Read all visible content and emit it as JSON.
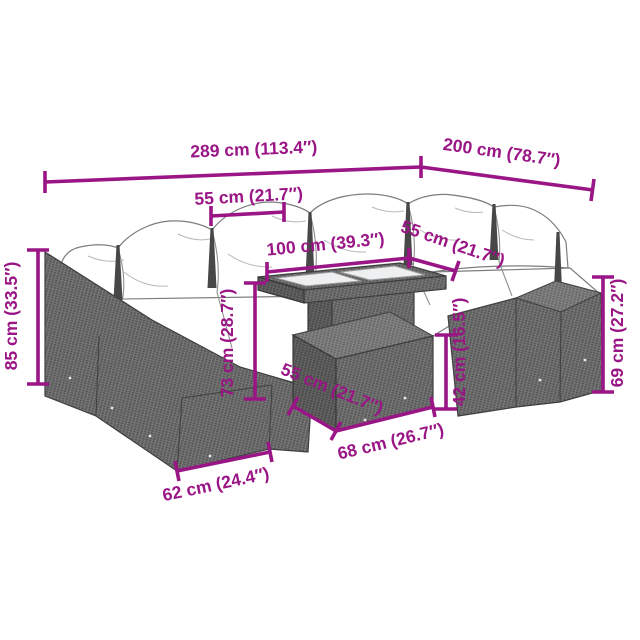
{
  "colors": {
    "dimension_magenta": "#9a1585",
    "rattan_gray": "#6f6f6f",
    "outline_gray": "#3e3e3e",
    "cushion_white": "#ffffff",
    "glass_gray": "#edeff0",
    "background": "#ffffff"
  },
  "diagram": {
    "type": "product-dimension-diagram",
    "subject": "rattan garden lounge set with cushions, glass-top table and footstool"
  },
  "dimensions": [
    {
      "name": "set-total-width",
      "label": "289 cm (113.4″)"
    },
    {
      "name": "set-side-depth",
      "label": "200 cm (78.7″)"
    },
    {
      "name": "seat-section-width",
      "label": "55 cm (21.7″)"
    },
    {
      "name": "table-top-width",
      "label": "100 cm (39.3″)"
    },
    {
      "name": "table-top-depth",
      "label": "55 cm (21.7″)"
    },
    {
      "name": "sofa-back-height",
      "label": "85 cm (33.5″)"
    },
    {
      "name": "table-height",
      "label": "73 cm (28.7″)"
    },
    {
      "name": "footstool-depth",
      "label": "55 cm (21.7″)"
    },
    {
      "name": "footstool-width",
      "label": "68 cm (26.7″)"
    },
    {
      "name": "footstool-height",
      "label": "42 cm (16.5″)"
    },
    {
      "name": "armrest-height",
      "label": "69 cm (27.2″)"
    },
    {
      "name": "seat-depth",
      "label": "62 cm (24.4″)"
    }
  ]
}
